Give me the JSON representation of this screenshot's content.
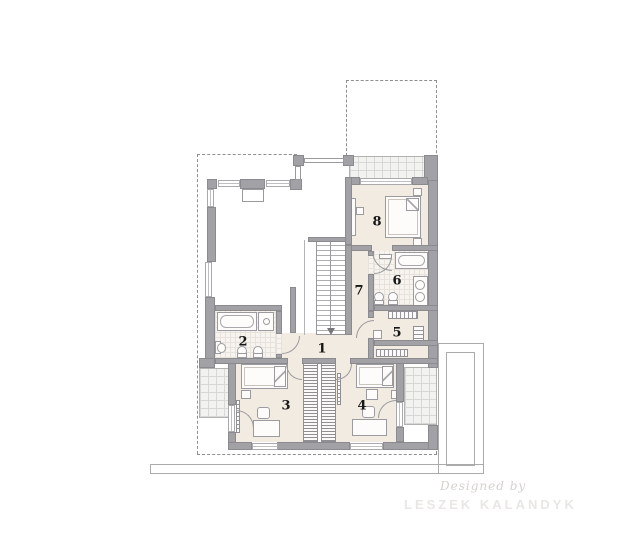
{
  "plan": {
    "room_labels": [
      {
        "number": "1"
      },
      {
        "number": "2"
      },
      {
        "number": "3"
      },
      {
        "number": "4"
      },
      {
        "number": "5"
      },
      {
        "number": "6"
      },
      {
        "number": "7"
      },
      {
        "number": "8"
      }
    ]
  },
  "watermark": {
    "designed_by": "Designed by",
    "studio": "LESZEK KALANDYK"
  },
  "colors": {
    "wall": "#a2a2a6",
    "wall_edge": "#8b8b8f",
    "room_floor": "#f2ebe2",
    "bath_tile": "#f7f4ef",
    "balcony_tile": "#f2f2f0",
    "roof_outline_dashed": "#8f8f8f",
    "lower_storey_outline": "#ababab",
    "room_label": "#161616",
    "watermark_script": "#d5d1cd",
    "watermark_name": "#e9e7e4"
  }
}
